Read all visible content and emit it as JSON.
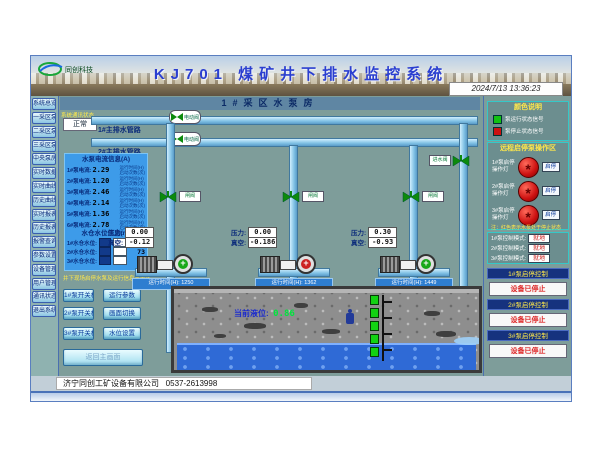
{
  "header": {
    "logo_text": "同创科技",
    "title": "KJ701 煤矿井下排水监控系统",
    "datetime": "2024/7/13 13:36:23"
  },
  "sidebar": {
    "items": [
      "系统总览",
      "一采区泵房",
      "二采区泵房",
      "三采区泵房",
      "中央泵房",
      "实时数据",
      "实时曲线",
      "历史曲线",
      "实时报表",
      "历史报表",
      "报警查询",
      "参数设置",
      "设备管理",
      "用户管理",
      "通讯状态",
      "退出系统"
    ]
  },
  "main": {
    "subtitle": "1#采区水泵房",
    "status": {
      "label": "系统通讯状态",
      "value": "正常"
    },
    "mains": {
      "line1": "1#主排水管路",
      "line2": "2#主排水管路",
      "valve1": "电动阀",
      "valve2": "电动阀",
      "inlet_valve": "进水阀"
    },
    "info_panel": {
      "title": "水泵电流信息(A)",
      "rows": [
        {
          "label": "1#泵电流:",
          "value": "2.29",
          "note1": "运行时间(H)",
          "note2": "启动次数(次)"
        },
        {
          "label": "2#泵电流:",
          "value": "1.20",
          "note1": "运行时间(H)",
          "note2": "启动次数(次)"
        },
        {
          "label": "3#泵电流:",
          "value": "2.46",
          "note1": "运行时间(H)",
          "note2": "启动次数(次)"
        },
        {
          "label": "4#泵电流:",
          "value": "2.14",
          "note1": "运行时间(H)",
          "note2": "启动次数(次)"
        },
        {
          "label": "5#泵电流:",
          "value": "1.36",
          "note1": "运行时间(H)",
          "note2": "启动次数(次)"
        },
        {
          "label": "6#泵电流:",
          "value": "2.78",
          "note1": "运行时间(H)",
          "note2": "启动次数(次)"
        }
      ],
      "level_title": "水仓水位信息(m)",
      "level_rows": [
        {
          "label": "1#水仓水位:",
          "value": "79"
        },
        {
          "label": "2#水仓水位:",
          "value": "73"
        },
        {
          "label": "3#水仓水位:",
          "value": "26"
        }
      ]
    },
    "control_area": {
      "title": "井下现场启停水泵及运行信息显示区",
      "buttons": [
        "1#泵开关机",
        "运行参数",
        "2#泵开关机",
        "画面切换",
        "3#泵开关机",
        "水位设置"
      ],
      "wide_button": "返回主画面"
    },
    "pumps": [
      {
        "valve_label": "闸阀",
        "pressure_label": "压力:",
        "pressure": "0.00",
        "vacuum_label": "真空:",
        "vacuum": "-0.12",
        "runtime_label": "运行时间(H):",
        "runtime": "1250"
      },
      {
        "valve_label": "闸阀",
        "pressure_label": "压力:",
        "pressure": "0.00",
        "vacuum_label": "真空:",
        "vacuum": "-0.186",
        "runtime_label": "运行时间(H):",
        "runtime": "1362"
      },
      {
        "valve_label": "闸阀",
        "pressure_label": "压力:",
        "pressure": "0.30",
        "vacuum_label": "真空:",
        "vacuum": "-0.93",
        "runtime_label": "运行时间(H):",
        "runtime": "1449"
      }
    ],
    "sump": {
      "level_label": "当前液位:",
      "level_value": "0.86"
    }
  },
  "right_panel": {
    "legend": {
      "title": "颜色说明",
      "running": "泵运行状态信号",
      "stopped": "泵停止状态信号"
    },
    "remote": {
      "title": "远程启停泵操作区",
      "rows": [
        {
          "label": "1#泵启停",
          "sub": "操作灯",
          "button": "启停"
        },
        {
          "label": "2#泵启停",
          "sub": "操作灯",
          "button": "启停"
        },
        {
          "label": "3#泵启停",
          "sub": "操作灯",
          "button": "启停"
        }
      ],
      "note": "注：红色表示水泵处于停止状态"
    },
    "modes": [
      {
        "label": "1#泵控制模式:",
        "value": "就地"
      },
      {
        "label": "2#泵控制模式:",
        "value": "就地"
      },
      {
        "label": "3#泵控制模式:",
        "value": "就地"
      }
    ],
    "controls": [
      {
        "header": "1#泵启停控制",
        "status": "设备已停止"
      },
      {
        "header": "2#泵启停控制",
        "status": "设备已停止"
      },
      {
        "header": "3#泵启停控制",
        "status": "设备已停止"
      }
    ]
  },
  "footer": {
    "company": "济宁同创工矿设备有限公司",
    "phone": "0537-2613998"
  },
  "colors": {
    "pump_running": "#18a818",
    "pump_stopped": "#cc2222",
    "lamp_red": "#cc1111",
    "legend_green": "#12c212",
    "water": "#2f6ad6",
    "pipe": "#9fd4ee",
    "info_panel_blue": "#3d9be9",
    "accent_yellow": "#ffe84a"
  }
}
